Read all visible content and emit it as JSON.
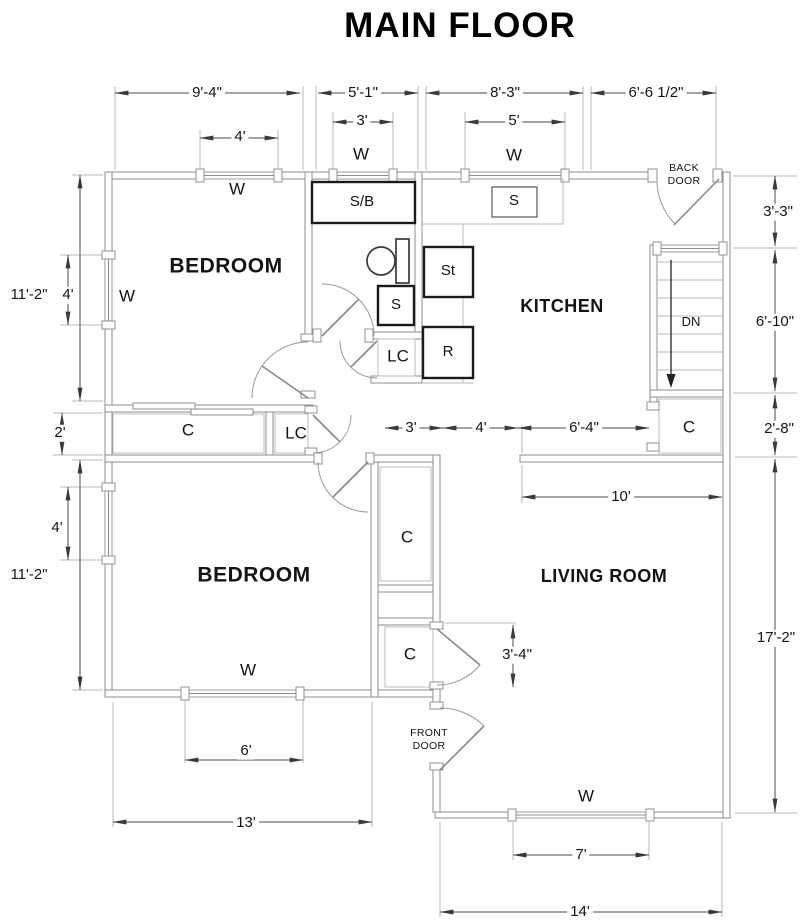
{
  "title": "MAIN FLOOR",
  "rooms": {
    "bedroom1": "BEDROOM",
    "bedroom2": "BEDROOM",
    "kitchen": "KITCHEN",
    "living_room": "LIVING ROOM"
  },
  "doors": {
    "back_door": "BACK DOOR",
    "front_door": "FRONT DOOR"
  },
  "stairs_label": "DN",
  "window_label": "W",
  "closet_label": "C",
  "linen_closet_label": "LC",
  "fixtures": {
    "shower_bath": "S/B",
    "bath_sink": "S",
    "kitchen_sink": "S",
    "stove": "St",
    "refrigerator": "R"
  },
  "dimensions": {
    "top": {
      "bedroom_width": "9'-4\"",
      "bath_width": "5'-1\"",
      "kitchen_width": "8'-3\"",
      "entry_width": "6'-6 1/2\"",
      "bedroom_window": "4'",
      "bath_window": "3'",
      "kitchen_window": "5'"
    },
    "left": {
      "bedroom1_depth": "11'-2\"",
      "bedroom1_window": "4'",
      "closet_depth": "2'",
      "bedroom2_depth": "11'-2\"",
      "bedroom2_window": "4'"
    },
    "right": {
      "landing_depth": "3'-3\"",
      "stairs_depth": "6'-10\"",
      "closet_depth": "2'-8\"",
      "living_depth": "17'-2\""
    },
    "middle": {
      "hall_a": "3'",
      "hall_b": "4'",
      "kitchen_opening": "6'-4\"",
      "living_width": "10'",
      "entry_closet": "3'-4\""
    },
    "bottom": {
      "bedroom2_window": "6'",
      "bedroom2_width": "13'",
      "living_window": "7'",
      "living_width": "14'"
    }
  },
  "colors": {
    "wall": "#8c8c8c",
    "fixture": "#1a1a1a",
    "dimension": "#4a4a4a",
    "text": "#141414"
  }
}
